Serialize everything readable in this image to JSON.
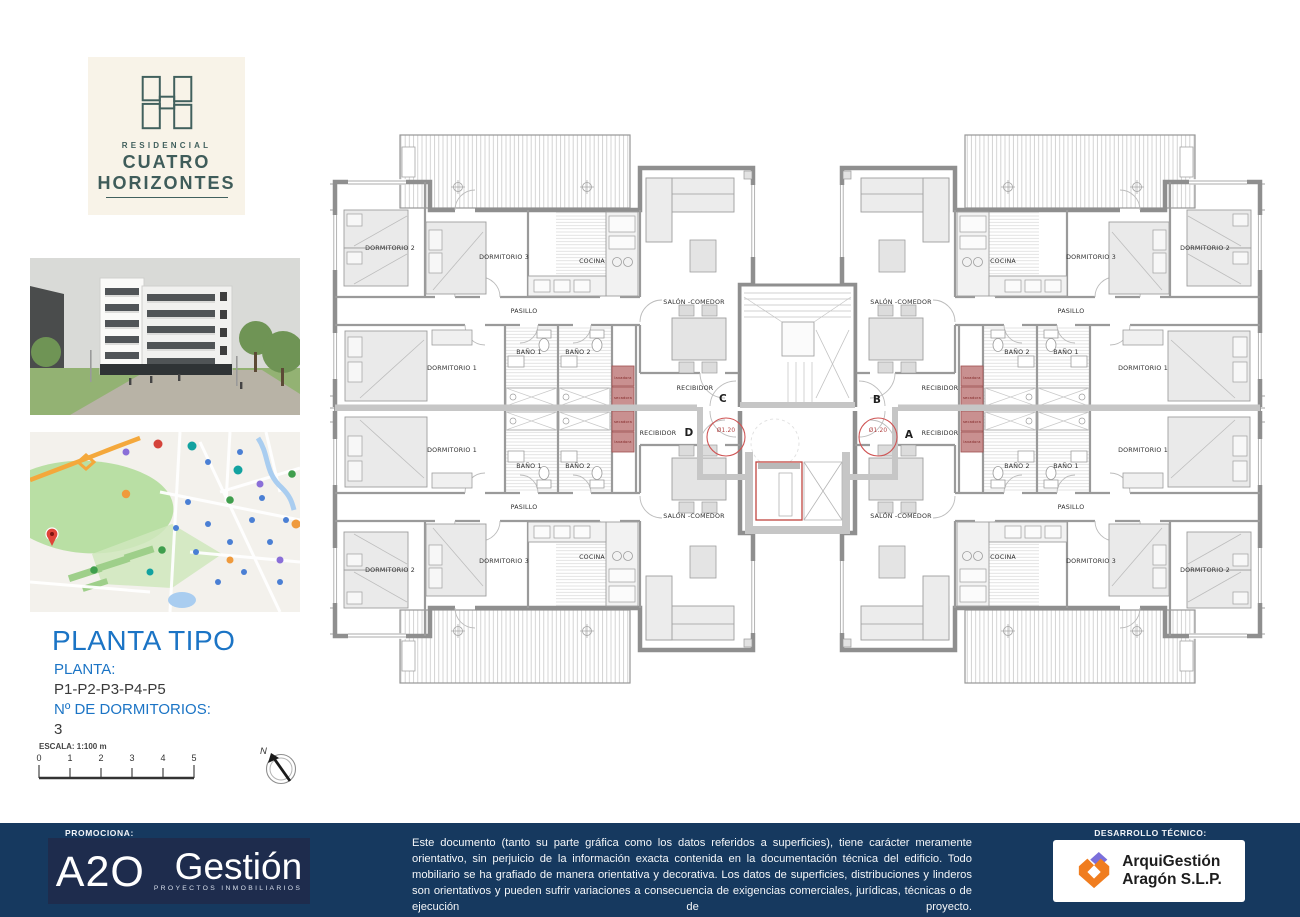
{
  "branding": {
    "residencial": "RESIDENCIAL",
    "line1": "CUATRO",
    "line2": "HORIZONTES"
  },
  "sidebar": {
    "title": "PLANTA TIPO",
    "planta_label": "PLANTA:",
    "planta_value": "P1-P2-P3-P4-P5",
    "dorm_label": "Nº DE DORMITORIOS:",
    "dorm_value": "3",
    "scale_label": "ESCALA: 1:100 m",
    "scale_ticks": [
      "0",
      "1",
      "2",
      "3",
      "4",
      "5"
    ],
    "north_label": "N"
  },
  "plan": {
    "rooms": [
      {
        "label": "DORMITORIO 2",
        "x": 390,
        "y": 248
      },
      {
        "label": "DORMITORIO 3",
        "x": 504,
        "y": 257
      },
      {
        "label": "COCINA",
        "x": 592,
        "y": 261
      },
      {
        "label": "PASILLO",
        "x": 524,
        "y": 311
      },
      {
        "label": "SALÓN -COMEDOR",
        "x": 694,
        "y": 302
      },
      {
        "label": "DORMITORIO 1",
        "x": 452,
        "y": 368
      },
      {
        "label": "BAÑO 1",
        "x": 529,
        "y": 352
      },
      {
        "label": "BAÑO 2",
        "x": 578,
        "y": 352
      }
    ],
    "recibidor": {
      "label": "RECIBIDOR",
      "positions": [
        [
          695,
          388
        ],
        [
          940,
          388
        ],
        [
          658,
          433
        ],
        [
          940,
          433
        ]
      ]
    },
    "apartments": [
      {
        "letter": "C",
        "x": 723,
        "y": 402
      },
      {
        "letter": "B",
        "x": 877,
        "y": 403
      },
      {
        "letter": "D",
        "x": 689,
        "y": 436
      },
      {
        "letter": "A",
        "x": 909,
        "y": 438
      }
    ],
    "turning_circles": [
      {
        "label": "Ø1.20",
        "x": 726,
        "y": 432,
        "cx": 726,
        "cy": 437
      },
      {
        "label": "Ø1.20",
        "x": 878,
        "y": 432,
        "cx": 878,
        "cy": 437
      }
    ],
    "appliances": [
      {
        "label": "lavadora",
        "x": 623,
        "y": 378
      },
      {
        "label": "secadora",
        "x": 623,
        "y": 398
      },
      {
        "label": "secadora",
        "x": 623,
        "y": 422
      },
      {
        "label": "lavadora",
        "x": 623,
        "y": 442
      },
      {
        "label": "lavadora",
        "x": 972,
        "y": 378
      },
      {
        "label": "secadora",
        "x": 972,
        "y": 398
      },
      {
        "label": "secadora",
        "x": 972,
        "y": 422
      },
      {
        "label": "lavadora",
        "x": 972,
        "y": 442
      }
    ]
  },
  "footer": {
    "promociona_label": "PROMOCIONA:",
    "promoter_name": "A2O",
    "promoter_name2": "Gestión",
    "promoter_sub": "PROYECTOS INMOBILIARIOS",
    "disclaimer": "Este documento (tanto su parte gráfica como los datos referidos a superficies), tiene carácter meramente orientativo, sin perjuicio de la información exacta contenida en la documentación técnica del edificio. Todo mobiliario se ha grafiado de manera orientativa y decorativa. Los datos de superficies, distribuciones y linderos son orientativos y pueden sufrir variaciones a consecuencia de exigencias comerciales, jurídicas, técnicas o de ejecución de proyecto.",
    "desarrollo_label": "DESARROLLO TÉCNICO:",
    "developer_name": "ArquiGestión",
    "developer_name2": "Aragón S.L.P."
  },
  "colors": {
    "heading_blue": "#1b74c5",
    "footer_navy": "#16395f",
    "logo_navy": "#1e2c4d",
    "logo_cream": "#f8f3e8",
    "logo_teal": "#41605d",
    "plan_red": "#cf5454",
    "appliance_fill": "#c99090",
    "arqui_orange": "#f07d1f",
    "arqui_purple": "#7b6fdb"
  }
}
